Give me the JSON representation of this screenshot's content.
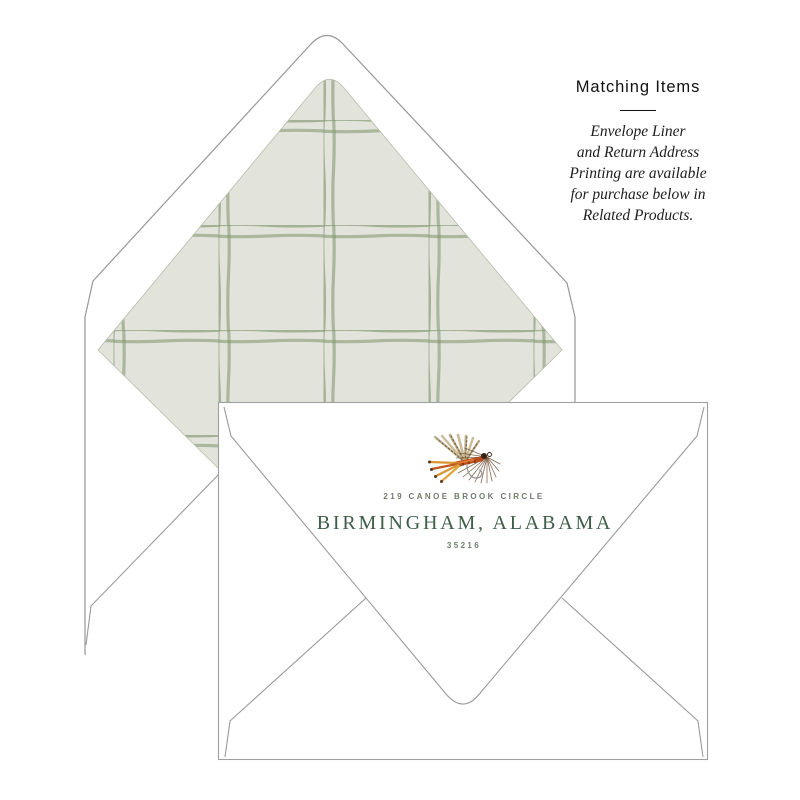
{
  "matching_items": {
    "title": "Matching Items",
    "lines": [
      "Envelope Liner",
      "and Return Address",
      "Printing are available",
      "for purchase below in",
      "Related Products."
    ]
  },
  "return_address": {
    "street": "219 CANOE BROOK CIRCLE",
    "city_state": "BIRMINGHAM, ALABAMA",
    "zip": "35216"
  },
  "colors": {
    "page_background": "#ffffff",
    "envelope_fill": "#ffffff",
    "envelope_outline": "#9a9a9a",
    "liner_background": "#e2e4db",
    "liner_plaid_green": "#7c916a",
    "address_green": "#3e5e47",
    "address_muted_green": "#6b7f67",
    "text_color": "#1c1c1c",
    "fly_orange": "#c2571f",
    "fly_gold": "#d9952f",
    "fly_brown": "#7b5a3f",
    "fly_tan": "#bfae8c"
  },
  "illustrations": {
    "fly_icon": "fly-fishing-lure",
    "liner_pattern": "green windowpane plaid"
  }
}
